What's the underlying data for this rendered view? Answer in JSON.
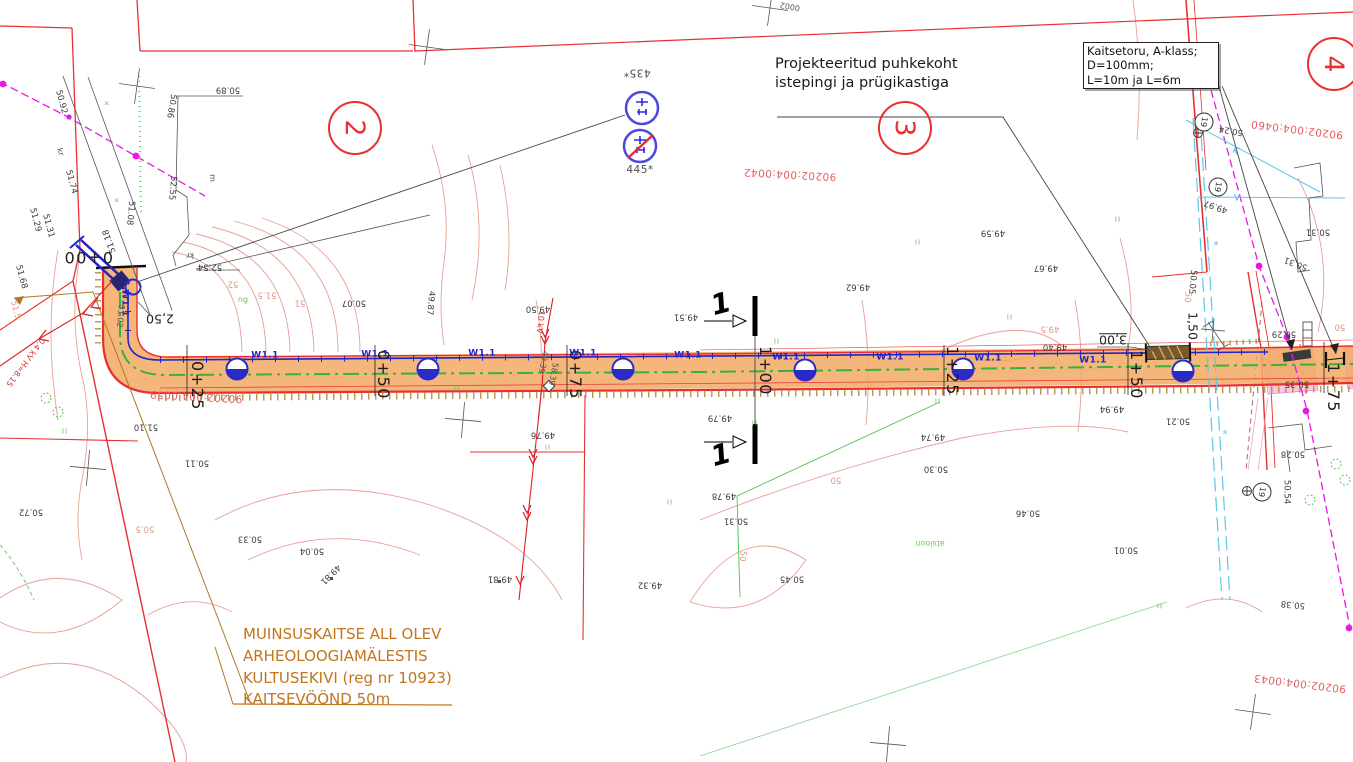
{
  "drawing": {
    "type": "road-and-pipeline site plan",
    "colors": {
      "road_fill": "#f2a963",
      "boundary_red": "#e83030",
      "pipeline_blue": "#2323c8",
      "centerline_green": "#35b33c",
      "cadastral_red": "#e36060",
      "heritage_orange": "#c2751c",
      "cable_magenta": "#e818e8",
      "drainage_cyan": "#5ac8e8",
      "contour_salmon": "#e6a094"
    }
  },
  "notes": {
    "rest_area": {
      "line1": "Projekteeritud puhkekoht",
      "line2": "istepingi ja prügikastiga"
    },
    "casing_box": {
      "line1": "Kaitsetoru, A-klass;",
      "line2": "D=100mm;",
      "line3": "L=10m ja L=6m"
    },
    "heritage": {
      "l1": "MUINSUSKAITSE ALL OLEV",
      "l2": "ARHEOLOOGIAMÄLESTIS",
      "l3": "KULTUSEKIVI (reg nr 10923)",
      "l4": "KAITSEVÖÖND 50m"
    }
  },
  "labels": {
    "stations": [
      {
        "t": "0+00",
        "x": 88,
        "y": 257,
        "r": 180
      },
      {
        "t": "0+25",
        "x": 197,
        "y": 386,
        "r": 90
      },
      {
        "t": "0+50",
        "x": 383,
        "y": 375,
        "r": 90
      },
      {
        "t": "0+75",
        "x": 575,
        "y": 375,
        "r": 90
      },
      {
        "t": "1+00",
        "x": 765,
        "y": 371,
        "r": 90
      },
      {
        "t": "1+25",
        "x": 952,
        "y": 371,
        "r": 90
      },
      {
        "t": "1+50",
        "x": 1136,
        "y": 375,
        "r": 90
      },
      {
        "t": "1+75",
        "x": 1333,
        "y": 388,
        "r": 90
      }
    ],
    "pipeline": [
      {
        "t": "W1.1",
        "x": 124,
        "y": 303,
        "r": 90
      },
      {
        "t": "W1.1",
        "x": 265,
        "y": 356
      },
      {
        "t": "W1.1",
        "x": 375,
        "y": 355
      },
      {
        "t": "W1.1",
        "x": 482,
        "y": 354
      },
      {
        "t": "W1.1",
        "x": 583,
        "y": 354
      },
      {
        "t": "W1.1",
        "x": 688,
        "y": 356
      },
      {
        "t": "W1.1",
        "x": 786,
        "y": 358
      },
      {
        "t": "W1.1",
        "x": 890,
        "y": 358
      },
      {
        "t": "W1.1",
        "x": 988,
        "y": 359
      },
      {
        "t": "W1.1",
        "x": 1093,
        "y": 361
      }
    ],
    "dimensions": [
      {
        "t": "2,50",
        "x": 160,
        "y": 318,
        "r": 180
      },
      {
        "t": "3,00",
        "x": 1113,
        "y": 339,
        "r": 180,
        "u": true
      },
      {
        "t": "1,50",
        "x": 1192,
        "y": 326,
        "r": 90
      }
    ],
    "sheet_numbers": [
      {
        "t": "2",
        "x": 355,
        "y": 128,
        "r": 90
      },
      {
        "t": "3",
        "x": 905,
        "y": 128,
        "r": 90
      },
      {
        "t": "4",
        "x": 1334,
        "y": 64,
        "r": 90
      }
    ],
    "circled_19": [
      {
        "t": "19",
        "x": 1204,
        "y": 122,
        "r": 100
      },
      {
        "t": "19",
        "x": 1218,
        "y": 187,
        "r": 100
      },
      {
        "t": "19",
        "x": 1262,
        "y": 492,
        "r": 100
      }
    ],
    "sign_numbers": [
      {
        "t": "435*",
        "x": 637,
        "y": 72,
        "r": 180
      },
      {
        "t": "445*",
        "x": 640,
        "y": 170,
        "r": 0
      }
    ],
    "section_numbers": [
      {
        "t": "1",
        "x": 721,
        "y": 304,
        "r": -15
      },
      {
        "t": "1",
        "x": 721,
        "y": 455,
        "r": -15
      }
    ],
    "cadastral": [
      {
        "t": "90202:004:0042",
        "x": 790,
        "y": 174,
        "r": 183
      },
      {
        "t": "90202:004:0059",
        "x": 196,
        "y": 396,
        "r": 183
      },
      {
        "t": "90202:004:0460",
        "x": 1297,
        "y": 129,
        "r": 187
      },
      {
        "t": "90202:004:0043",
        "x": 1300,
        "y": 683,
        "r": 187
      }
    ],
    "elevations": [
      {
        "t": "50.89",
        "x": 228,
        "y": 89,
        "r": 180
      },
      {
        "t": "50.86",
        "x": 171,
        "y": 106,
        "r": 100
      },
      {
        "t": "50.92",
        "x": 61,
        "y": 102,
        "r": 75
      },
      {
        "t": "51.74",
        "x": 71,
        "y": 182,
        "r": 75
      },
      {
        "t": "51.29",
        "x": 35,
        "y": 220,
        "r": 75
      },
      {
        "t": "51.31",
        "x": 48,
        "y": 226,
        "r": 75
      },
      {
        "t": "51.68",
        "x": 21,
        "y": 277,
        "r": 75
      },
      {
        "t": "51.18",
        "x": 110,
        "y": 241,
        "r": 250
      },
      {
        "t": "51.08",
        "x": 130,
        "y": 213,
        "r": 95
      },
      {
        "t": "52.55",
        "x": 172,
        "y": 188,
        "r": 95
      },
      {
        "t": "52.54",
        "x": 210,
        "y": 266,
        "r": 180
      },
      {
        "t": "51.10",
        "x": 146,
        "y": 426,
        "r": 180
      },
      {
        "t": "50.72",
        "x": 31,
        "y": 511,
        "r": 180
      },
      {
        "t": "50.07",
        "x": 354,
        "y": 302,
        "r": 180
      },
      {
        "t": "49.87",
        "x": 430,
        "y": 303,
        "r": 95
      },
      {
        "t": "49.50",
        "x": 538,
        "y": 308,
        "r": 180
      },
      {
        "t": "50.11",
        "x": 197,
        "y": 462,
        "r": 180
      },
      {
        "t": "50.33",
        "x": 250,
        "y": 538,
        "r": 180
      },
      {
        "t": "50.04",
        "x": 312,
        "y": 550,
        "r": 180
      },
      {
        "t": "49.81",
        "x": 330,
        "y": 574,
        "r": 135
      },
      {
        "t": "49.76",
        "x": 543,
        "y": 434,
        "r": 180
      },
      {
        "t": "49.81",
        "x": 500,
        "y": 578,
        "r": 180
      },
      {
        "t": "49.32",
        "x": 650,
        "y": 584,
        "r": 180
      },
      {
        "t": "49.51",
        "x": 686,
        "y": 316,
        "r": 180
      },
      {
        "t": "49.79",
        "x": 720,
        "y": 417,
        "r": 180
      },
      {
        "t": "49.78",
        "x": 724,
        "y": 495,
        "r": 180
      },
      {
        "t": "50.31",
        "x": 736,
        "y": 520,
        "r": 180
      },
      {
        "t": "50.45",
        "x": 792,
        "y": 578,
        "r": 180
      },
      {
        "t": "49.62",
        "x": 858,
        "y": 286,
        "r": 180
      },
      {
        "t": "49.59",
        "x": 993,
        "y": 232,
        "r": 180
      },
      {
        "t": "49.67",
        "x": 1046,
        "y": 267,
        "r": 180
      },
      {
        "t": "49.40",
        "x": 1055,
        "y": 346,
        "r": 180
      },
      {
        "t": "49.74",
        "x": 933,
        "y": 436,
        "r": 180
      },
      {
        "t": "50.30",
        "x": 936,
        "y": 468,
        "r": 180
      },
      {
        "t": "50.46",
        "x": 1028,
        "y": 512,
        "r": 180
      },
      {
        "t": "50.01",
        "x": 1126,
        "y": 549,
        "r": 180
      },
      {
        "t": "49.94",
        "x": 1112,
        "y": 408,
        "r": 180
      },
      {
        "t": "50.21",
        "x": 1178,
        "y": 420,
        "r": 180
      },
      {
        "t": "50.05",
        "x": 1192,
        "y": 282,
        "r": 95
      },
      {
        "t": "49.97",
        "x": 1216,
        "y": 206,
        "r": 200
      },
      {
        "t": "50.24",
        "x": 1231,
        "y": 130,
        "r": 190
      },
      {
        "t": "50.31",
        "x": 1318,
        "y": 231,
        "r": 180
      },
      {
        "t": "50.31",
        "x": 1296,
        "y": 263,
        "r": 200
      },
      {
        "t": "50.29",
        "x": 1284,
        "y": 333,
        "r": 180
      },
      {
        "t": "50.35",
        "x": 1297,
        "y": 383,
        "r": 180
      },
      {
        "t": "50.28",
        "x": 1293,
        "y": 453,
        "r": 180
      },
      {
        "t": "50.54",
        "x": 1286,
        "y": 492,
        "r": 90
      },
      {
        "t": "50.38",
        "x": 1293,
        "y": 604,
        "r": 185
      }
    ],
    "contours": [
      {
        "t": "52",
        "x": 233,
        "y": 283,
        "r": 180
      },
      {
        "t": "51.5",
        "x": 267,
        "y": 294,
        "r": 180
      },
      {
        "t": "51",
        "x": 300,
        "y": 302,
        "r": 180
      },
      {
        "t": "51.5",
        "x": 15,
        "y": 310,
        "r": 75
      },
      {
        "t": "50.5",
        "x": 145,
        "y": 528,
        "r": 180
      },
      {
        "t": "50",
        "x": 836,
        "y": 479,
        "r": 180
      },
      {
        "t": "50",
        "x": 742,
        "y": 556,
        "r": 95
      },
      {
        "t": "49.5",
        "x": 1050,
        "y": 328,
        "r": 180
      },
      {
        "t": "50",
        "x": 1187,
        "y": 297,
        "r": 95
      },
      {
        "t": "50",
        "x": 1340,
        "y": 326,
        "r": 180
      }
    ],
    "green_marks": [
      {
        "t": "II",
        "x": 65,
        "y": 432
      },
      {
        "t": "II",
        "x": 457,
        "y": 390
      },
      {
        "t": "II",
        "x": 548,
        "y": 448
      },
      {
        "t": "II",
        "x": 670,
        "y": 503
      },
      {
        "t": "II",
        "x": 755,
        "y": 424
      },
      {
        "t": "II",
        "x": 777,
        "y": 342
      },
      {
        "t": "II",
        "x": 918,
        "y": 243
      },
      {
        "t": "II",
        "x": 1010,
        "y": 318
      },
      {
        "t": "II",
        "x": 1118,
        "y": 220
      },
      {
        "t": "II",
        "x": 938,
        "y": 402
      },
      {
        "t": "II",
        "x": 1160,
        "y": 607
      },
      {
        "t": "×",
        "x": 107,
        "y": 104
      },
      {
        "t": "×",
        "x": 117,
        "y": 201
      }
    ],
    "green_text": [
      {
        "t": "ng",
        "x": 243,
        "y": 300
      },
      {
        "t": "atsioon",
        "x": 930,
        "y": 543,
        "r": 180
      }
    ],
    "red_utility": [
      {
        "t": "10 kV",
        "x": 540,
        "y": 322,
        "r": 97
      },
      {
        "t": "0.4 kV H=8.15",
        "x": 25,
        "y": 362,
        "r": 127
      }
    ],
    "cyan_labels": [
      {
        "t": "K",
        "x": 1235,
        "y": 152,
        "r": 25
      },
      {
        "t": "V",
        "x": 1237,
        "y": 199,
        "r": 0
      },
      {
        "t": "«",
        "x": 1215,
        "y": 243,
        "r": 100
      },
      {
        "t": "«",
        "x": 1224,
        "y": 432,
        "r": 100
      }
    ],
    "misc": [
      {
        "t": "kr",
        "x": 60,
        "y": 152,
        "r": 75
      },
      {
        "t": "kr",
        "x": 190,
        "y": 255,
        "r": 180
      },
      {
        "t": "m",
        "x": 212,
        "y": 178,
        "r": 90
      },
      {
        "t": "0002",
        "x": 790,
        "y": 6,
        "r": 190
      },
      {
        "t": "51.02",
        "x": 120,
        "y": 316,
        "r": 95
      },
      {
        "t": "58.39",
        "x": 553,
        "y": 374,
        "r": 100
      },
      {
        "t": "49.39",
        "x": 543,
        "y": 362,
        "r": 100
      }
    ]
  }
}
